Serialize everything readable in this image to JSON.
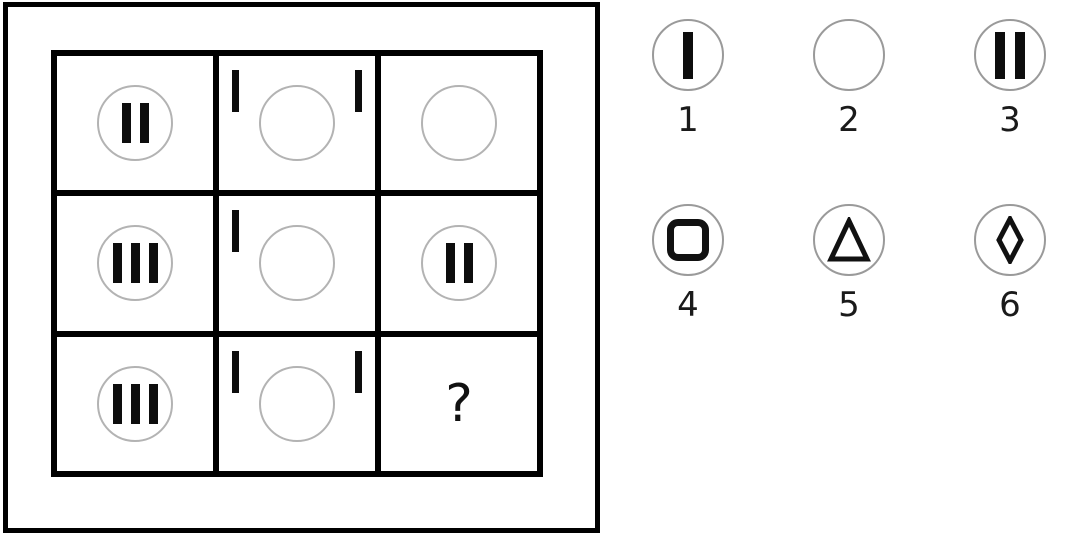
{
  "puzzle": {
    "question_mark": "?",
    "grid": {
      "rows": 3,
      "cols": 3,
      "cells": [
        {
          "name": "r1c1",
          "circle": true,
          "bars_in_circle": 2,
          "ticks": [],
          "question": false
        },
        {
          "name": "r1c2",
          "circle": true,
          "bars_in_circle": 0,
          "ticks": [
            "top-left",
            "top-right"
          ],
          "question": false
        },
        {
          "name": "r1c3",
          "circle": true,
          "bars_in_circle": 0,
          "ticks": [],
          "question": false
        },
        {
          "name": "r2c1",
          "circle": true,
          "bars_in_circle": 3,
          "ticks": [],
          "question": false
        },
        {
          "name": "r2c2",
          "circle": true,
          "bars_in_circle": 0,
          "ticks": [
            "top-left"
          ],
          "question": false
        },
        {
          "name": "r2c3",
          "circle": true,
          "bars_in_circle": 2,
          "ticks": [],
          "question": false
        },
        {
          "name": "r3c1",
          "circle": true,
          "bars_in_circle": 3,
          "ticks": [],
          "question": false
        },
        {
          "name": "r3c2",
          "circle": true,
          "bars_in_circle": 0,
          "ticks": [
            "top-left",
            "top-right"
          ],
          "question": false
        },
        {
          "name": "r3c3",
          "circle": false,
          "bars_in_circle": 0,
          "ticks": [],
          "question": true
        }
      ]
    }
  },
  "options": [
    {
      "number": "1",
      "symbol": "single-bar"
    },
    {
      "number": "2",
      "symbol": "empty-circle"
    },
    {
      "number": "3",
      "symbol": "double-bar"
    },
    {
      "number": "4",
      "symbol": "square-outline"
    },
    {
      "number": "5",
      "symbol": "triangle-outline"
    },
    {
      "number": "6",
      "symbol": "diamond-outline"
    }
  ],
  "colors": {
    "ink": "#0d0d0d",
    "grid_line": "#000000",
    "grid_circle_outline": "#b3b3b3",
    "option_circle_outline": "#9a9a9a",
    "background": "#ffffff"
  }
}
